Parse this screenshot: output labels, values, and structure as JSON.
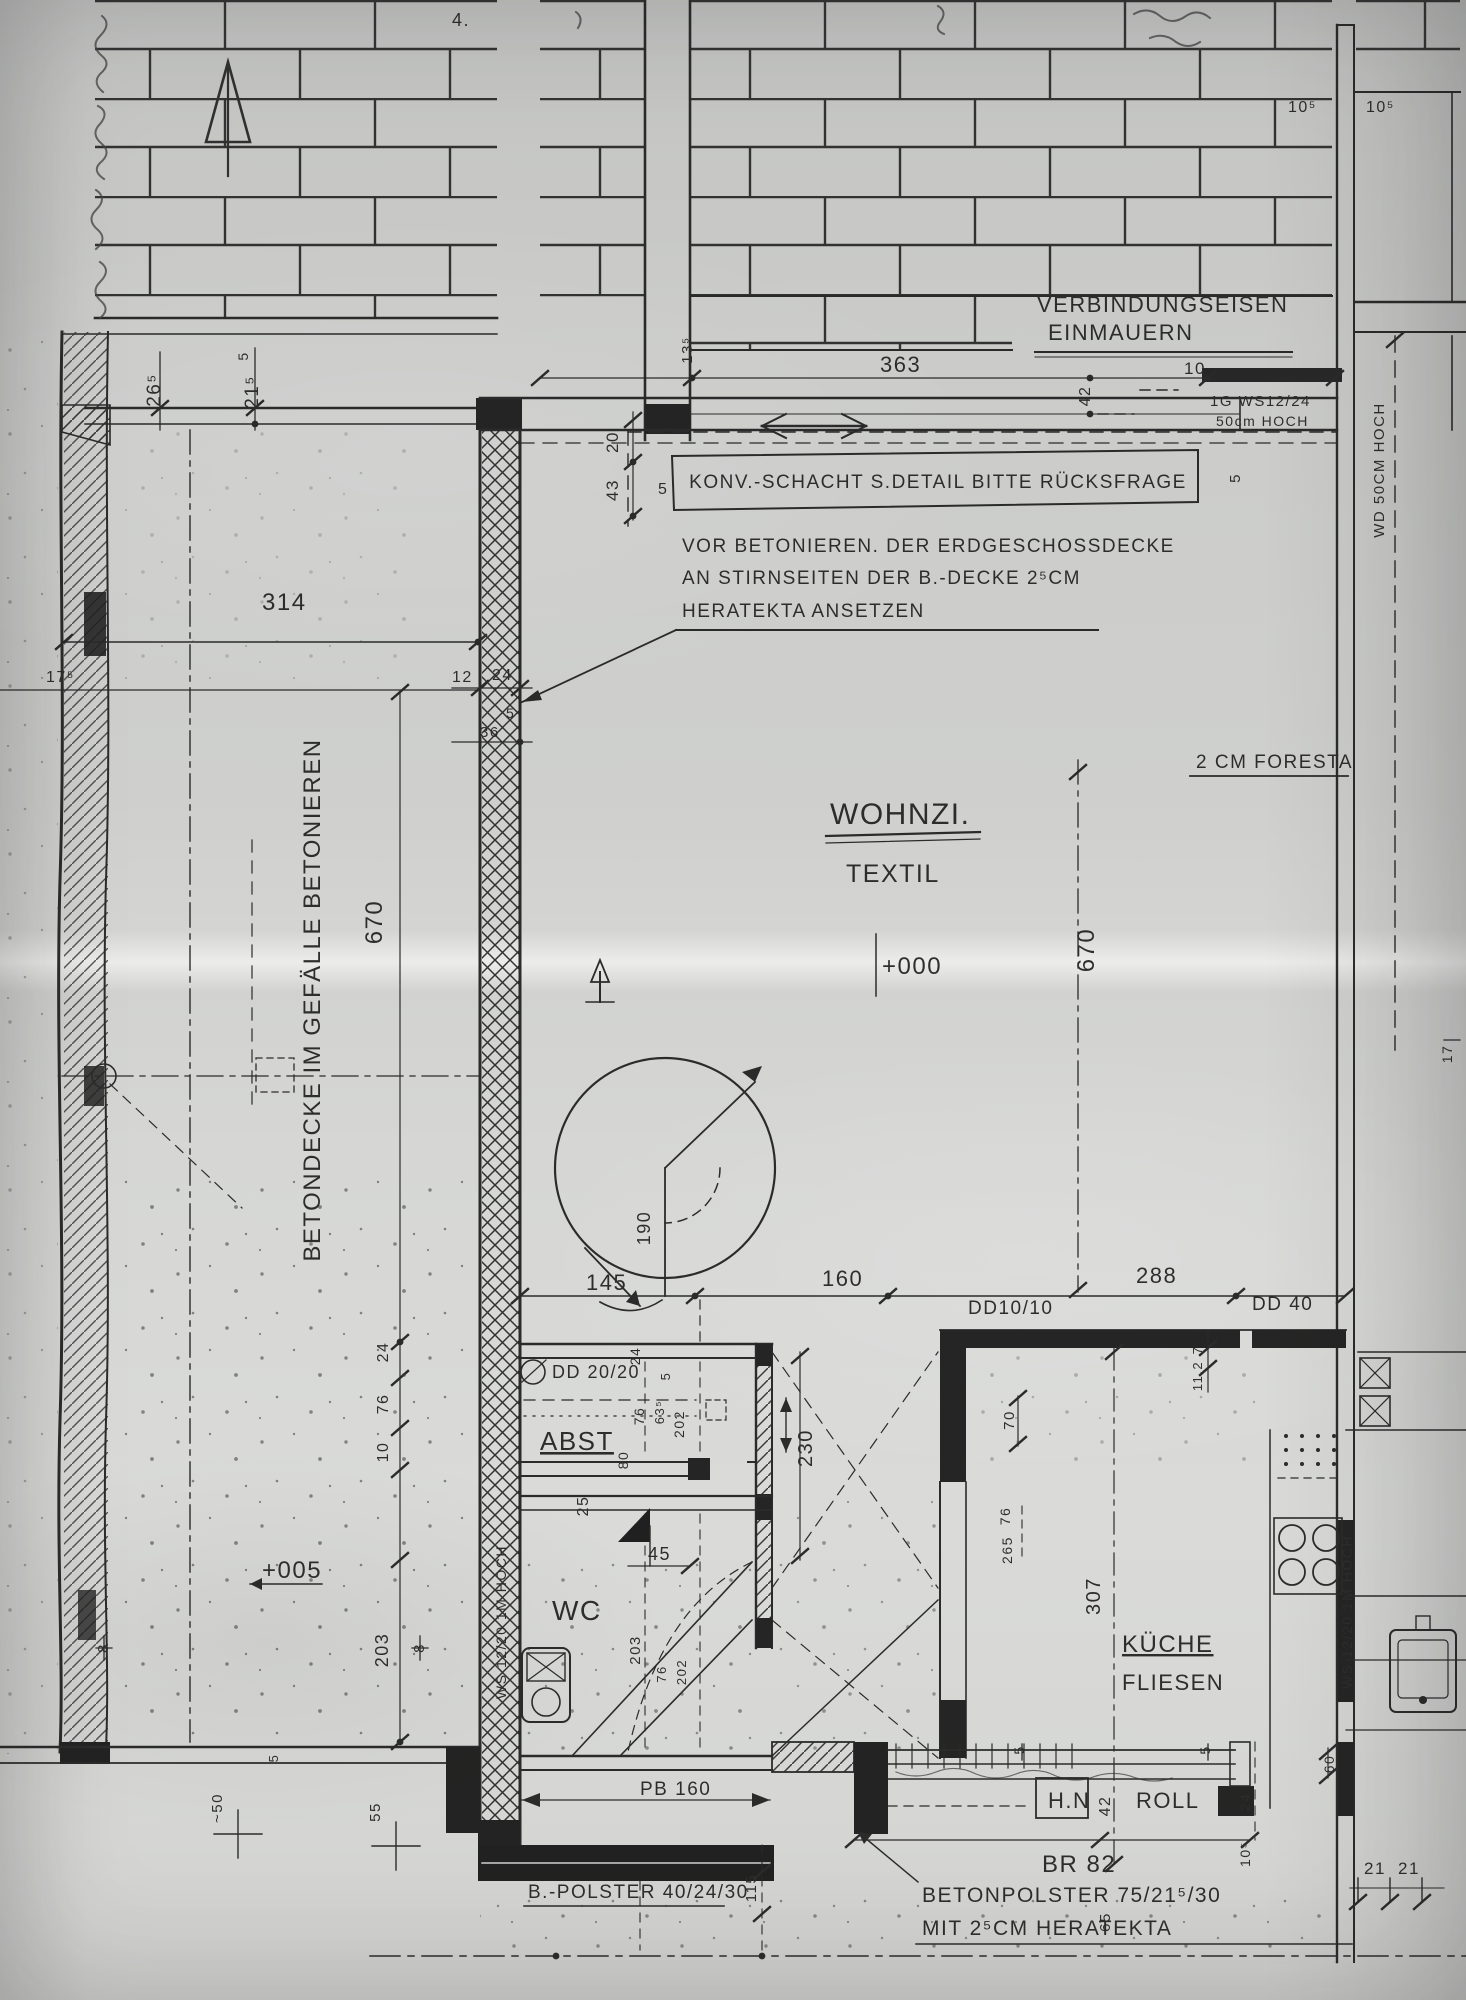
{
  "plan": {
    "colors": {
      "ink": "#1d1d1d",
      "paper": "#d4d5d3",
      "fill_black": "#161616"
    },
    "rooms": {
      "wohnzimmer": {
        "label": "WOHNZI.",
        "floor": "TEXTIL",
        "elevation": "+000"
      },
      "abstellraum": {
        "label": "ABST"
      },
      "wc": {
        "label": "WC"
      },
      "kueche": {
        "label": "KÜCHE",
        "floor": "FLIESEN"
      },
      "terrasse": {
        "note": "BETONDECKE IM GEFÄLLE BETONIEREN",
        "elevation": "+005"
      }
    },
    "notes": {
      "verbindungseisen_1": "VERBINDUNGSEISEN",
      "verbindungseisen_2": "EINMAUERN",
      "konv_schacht": "KONV.-SCHACHT  S.DETAIL  BITTE  RÜCKSFRAGE",
      "betonieren_1": "VOR  BETONIEREN. DER  ERDGESCHOSSDECKE",
      "betonieren_2": "AN  STIRNSEITEN  DER  B.-DECKE  2⁵CM",
      "betonieren_3": "HERATEKTA  ANSETZEN",
      "foresta": "2 CM  FORESTA",
      "betonpolster_1": "BETONPOLSTER 75/21⁵/30",
      "betonpolster_2": "MIT 2⁵CM  HERATEKTA",
      "b_polster": "B.-POLSTER  40/24/30",
      "br82": "BR 82",
      "hn": "H.N",
      "roll": "ROLL",
      "pb160": "PB 160",
      "handnote": "4."
    },
    "walls": {
      "ws_left": "WS 12/20  1M HOCH",
      "ws_right": "WS 12/20  1M HOCH",
      "ws_12_24": "1G  WS12/24",
      "ws_12_24_h": "50cm HOCH",
      "wd50": "WD 50CM HOCH",
      "dd2020": "DD 20/20",
      "dd1010": "DD10/10",
      "dd40": "DD  40"
    },
    "dims": {
      "d363": "363",
      "d314": "314",
      "d670l": "670",
      "d670r": "670",
      "d145": "145",
      "d160": "160",
      "d288": "288",
      "d230": "230",
      "d307": "307",
      "d190": "190",
      "d115": "115",
      "d26_5": "26⁵",
      "d21_5": "21⁵",
      "d17_5": "17⁵",
      "d13_5": "13⁵",
      "d43": "43",
      "d20": "20",
      "d10": "10",
      "d42a": "42",
      "d42b": "42",
      "d12": "12",
      "d24a": "24",
      "d24b": "24",
      "d24c": "24",
      "d24d": "24",
      "d36": "36",
      "d76a": "76",
      "d76b": "76",
      "d76c": "76",
      "d76d": "76",
      "d10b": "10",
      "d203a": "203",
      "d203b": "203",
      "d202a": "202",
      "d202b": "202",
      "d63_5": "63⁵",
      "d80": "80",
      "d25": "25",
      "d45": "45",
      "d70": "70",
      "d2_65": "265",
      "d7": "7",
      "d112": "11.2",
      "d55": "55",
      "d50": "~50",
      "d65": "65",
      "d60": "60",
      "d10_5a": "10⁵",
      "d10_5b": "10⁵",
      "d10_5c": "10⁵",
      "d21a": "21",
      "d21b": "21",
      "d17": "17",
      "d8a": "8",
      "d8b": "8",
      "d5a": "5",
      "d5b": "5",
      "d5c": "5",
      "d5d": "5",
      "d5e": "5",
      "d5f": "5",
      "d5g": "5",
      "d5h": "5"
    }
  }
}
